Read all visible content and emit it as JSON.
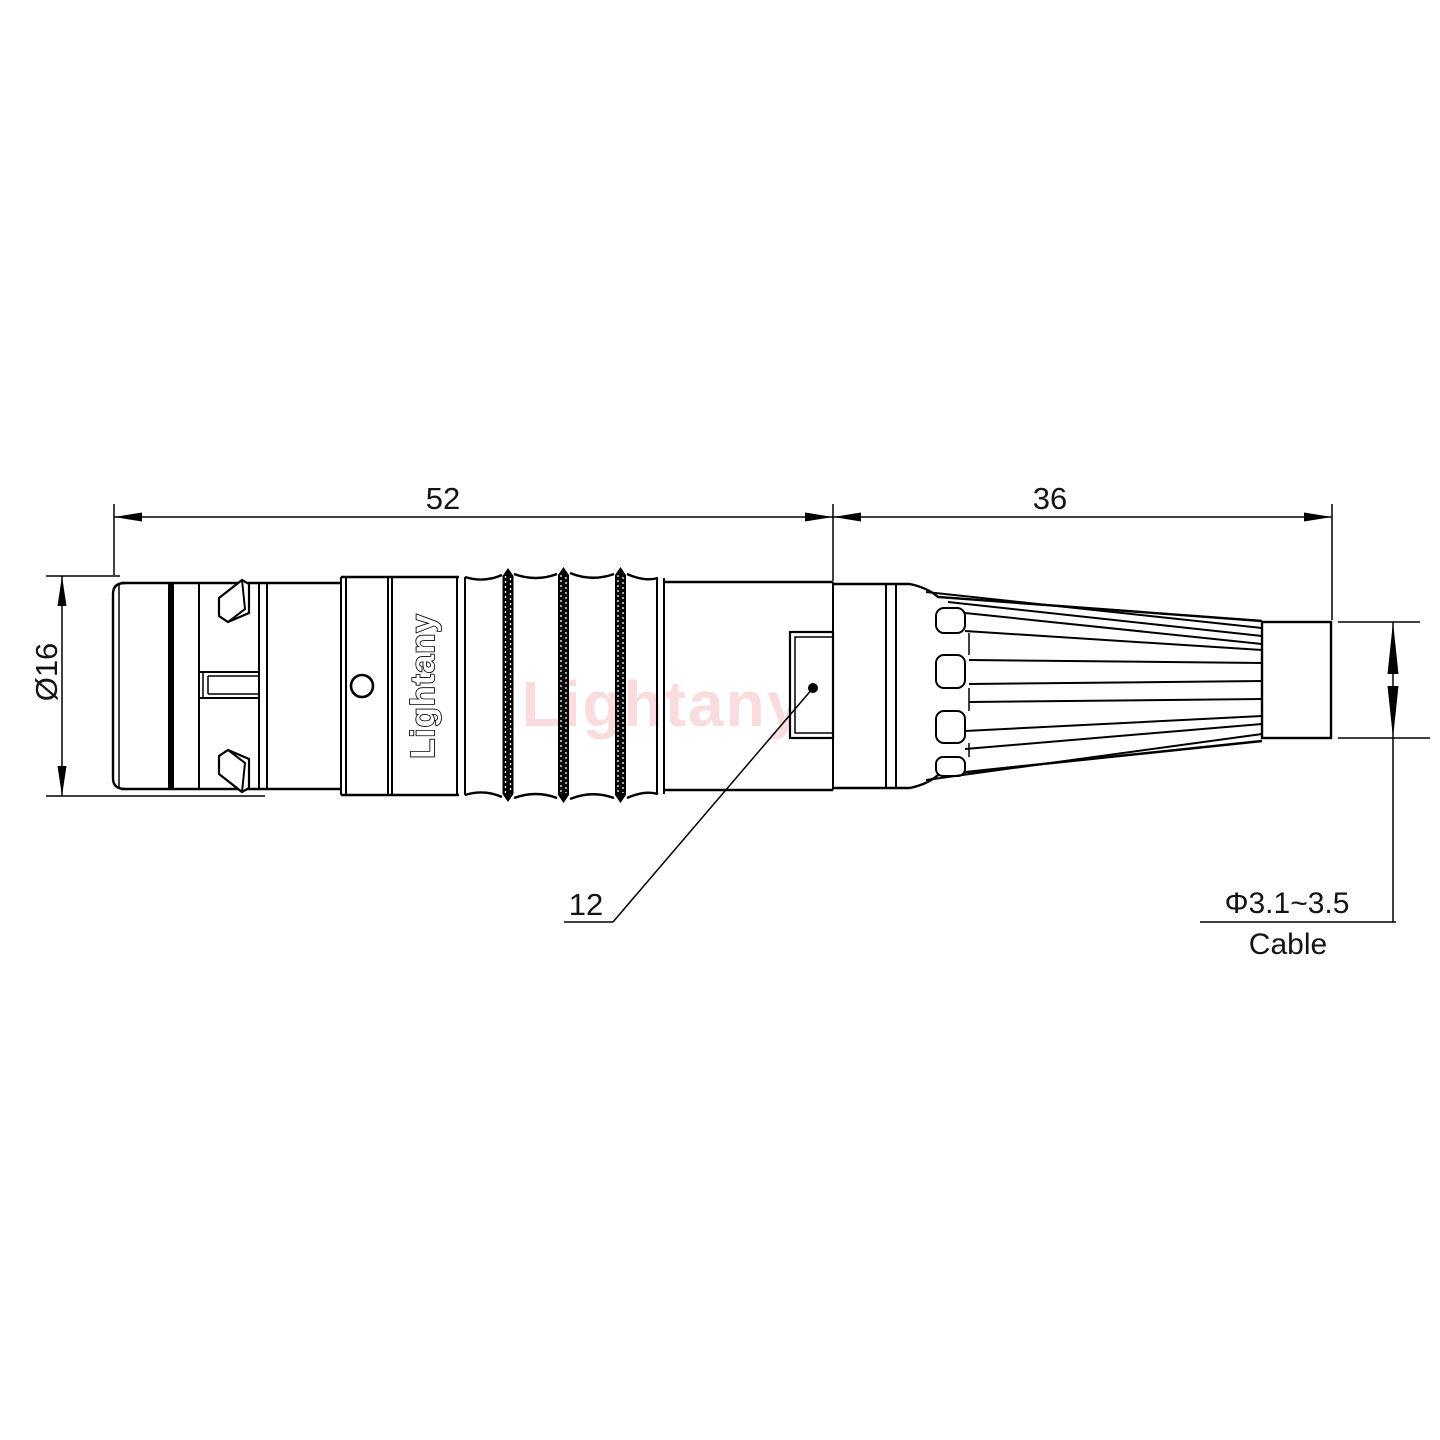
{
  "title": "Lightany circular push-pull connector outline drawing",
  "dimensions": {
    "body_length": "52",
    "rear_length": "36",
    "shell_diameter": "16",
    "shell_diameter_label": "Ø16",
    "nut_flat": "12",
    "cable_range_label": "Φ3.1~3.5",
    "cable_word": "Cable"
  },
  "branding": {
    "body_label": "Lightany",
    "watermark": "Lightany"
  },
  "colors": {
    "line": "#000000",
    "background": "#ffffff",
    "watermark": "#f5c0c2"
  }
}
